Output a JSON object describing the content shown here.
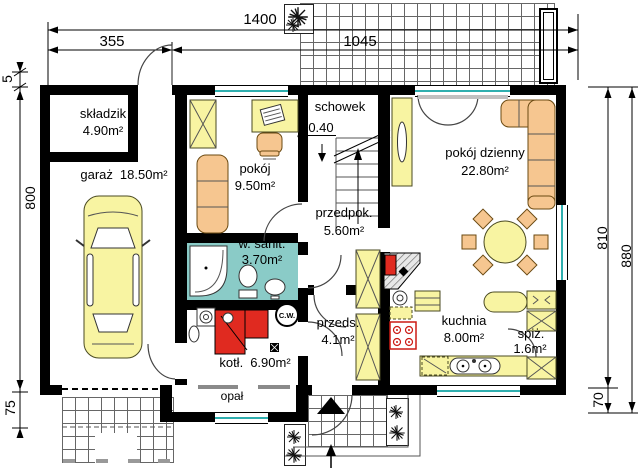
{
  "rooms": {
    "skladzik": {
      "name": "składzik",
      "area": "4.90m²"
    },
    "garaz": {
      "name": "garaż",
      "area": "18.50m²"
    },
    "pokoj": {
      "name": "pokój",
      "area": "9.50m²"
    },
    "schowek": {
      "name": "schowek",
      "level": "-0.40"
    },
    "pokoj_dzienny": {
      "name": "pokój dzienny",
      "area": "22.80m²"
    },
    "przedpok": {
      "name": "przedpok.",
      "area": "5.60m²"
    },
    "w_sanit": {
      "name": "w. sanit.",
      "area": "3.70m²"
    },
    "przeds": {
      "name": "przeds.",
      "area": "4.1m²"
    },
    "kuchnia": {
      "name": "kuchnia",
      "area": "8.00m²"
    },
    "spiz": {
      "name": "spiż.",
      "area": "1.6m²"
    },
    "kotl": {
      "name": "kotł.",
      "area": "6.90m²"
    },
    "opal": {
      "name": "opał"
    }
  },
  "labels": {
    "hot_water_tank": "C.W."
  },
  "icons": {
    "level_marker": "▽"
  },
  "dimensions": {
    "top_total": "1400",
    "top_left": "355",
    "top_right": "1045",
    "left_top": "5",
    "left_middle": "800",
    "left_bottom": "75",
    "right_inner": "810",
    "right_outer": "880",
    "right_bottom": "70"
  },
  "colors": {
    "wall": "#000000",
    "furniture": "#F8F4A2",
    "upholstery": "#F6C690",
    "bathroom": "#8ACBC7",
    "red": "#E02A20",
    "glass": "#2FAFAF",
    "tile": "#666666"
  }
}
